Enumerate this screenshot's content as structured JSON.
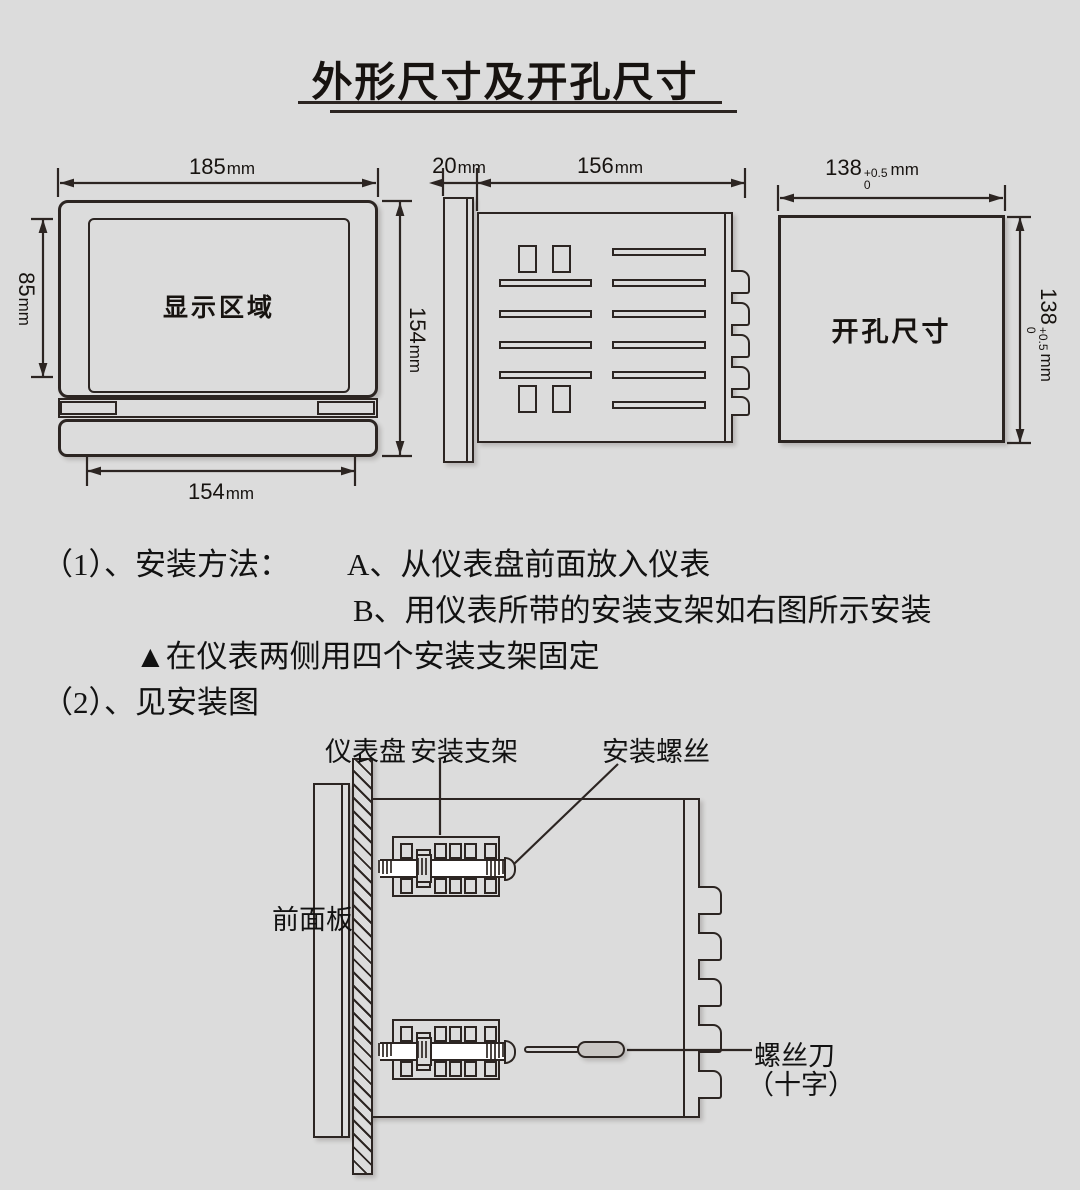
{
  "title": "外形尺寸及开孔尺寸",
  "colors": {
    "background": "#dcdcdc",
    "line": "#2c2522",
    "text": "#171310",
    "handle_fill": "#c9c6c3"
  },
  "front_view": {
    "display_label": "显示区域",
    "dims": {
      "width": {
        "value": "185",
        "unit": "mm"
      },
      "height": {
        "value": "154",
        "unit": "mm"
      },
      "display_height": {
        "value": "85",
        "unit": "mm"
      },
      "bottom_width": {
        "value": "154",
        "unit": "mm"
      }
    }
  },
  "side_view": {
    "dims": {
      "front_depth": {
        "value": "20",
        "unit": "mm"
      },
      "body_depth": {
        "value": "156",
        "unit": "mm"
      }
    }
  },
  "cutout_view": {
    "label": "开孔尺寸",
    "dims": {
      "width": {
        "value": "138",
        "tol_upper": "+0.5",
        "tol_lower": "0",
        "unit": "mm"
      },
      "height": {
        "value": "138",
        "tol_upper": "+0.5",
        "tol_lower": "0",
        "unit": "mm"
      }
    }
  },
  "instructions": {
    "item1_label": "（1）、安装方法：",
    "item1_a": "A、从仪表盘前面放入仪表",
    "item1_b": "B、用仪表所带的安装支架如右图所示安装",
    "note": "▲在仪表两侧用四个安装支架固定",
    "item2": "（2）、见安装图"
  },
  "install_diagram": {
    "panel_label": "仪表盘",
    "bracket_label": "安装支架",
    "screw_label": "安装螺丝",
    "front_panel_label": "前面板",
    "screwdriver_label_1": "螺丝刀",
    "screwdriver_label_2": "（十字）"
  }
}
